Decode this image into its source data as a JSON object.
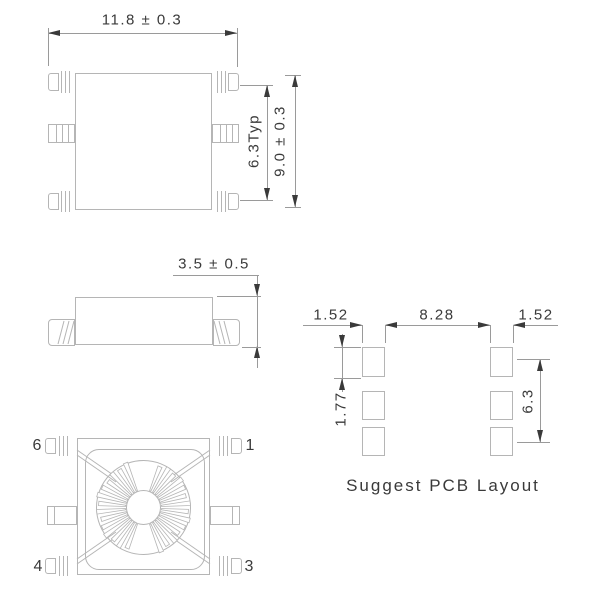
{
  "top_view": {
    "width_dim": "11.8 ± 0.3",
    "pin_span_dim": "6.3Typ",
    "height_dim": "9.0 ± 0.3"
  },
  "side_view": {
    "height_dim": "3.5 ± 0.5"
  },
  "bottom_view": {
    "pin_top_left": "6",
    "pin_top_right": "1",
    "pin_bottom_left": "4",
    "pin_bottom_right": "3"
  },
  "pcb_layout": {
    "pad_width_left_dim": "1.52",
    "pitch_dim": "8.28",
    "pad_width_right_dim": "1.52",
    "pad_height_dim": "1.77",
    "row_span_dim": "6.3",
    "caption": "Suggest PCB Layout"
  },
  "colors": {
    "outline": "#b5b5b5",
    "dimension_line": "#9a9a9a",
    "text": "#3a3a3a"
  }
}
